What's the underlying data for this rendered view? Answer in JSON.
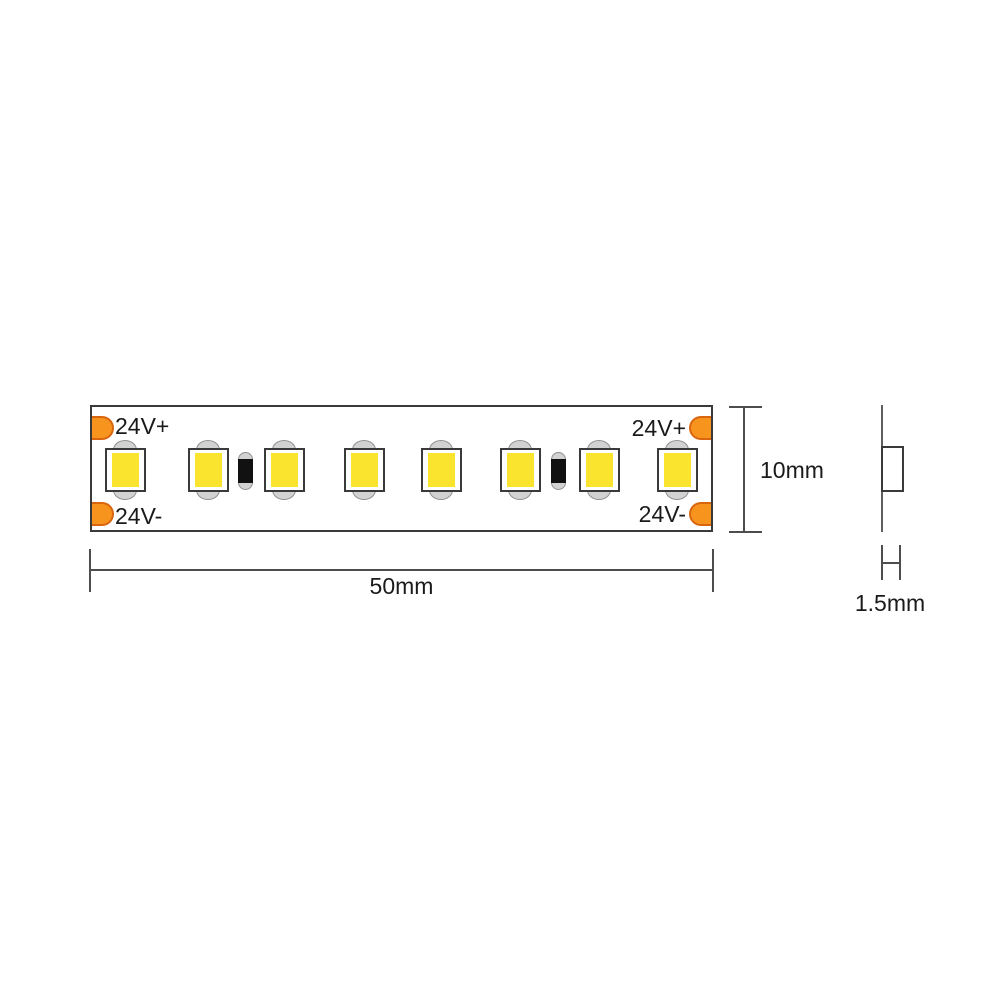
{
  "diagram": {
    "type": "led-strip-dimension-drawing",
    "pads": {
      "positive": "24V+",
      "negative": "24V-"
    },
    "dimensions": {
      "length": "50mm",
      "width": "10mm",
      "thickness": "1.5mm"
    },
    "components": {
      "led_count": 8,
      "resistor_count": 2,
      "led_centers_x": [
        125,
        208,
        284,
        364,
        441,
        520,
        599,
        677
      ],
      "resistor_centers_x": [
        245,
        558
      ]
    },
    "colors": {
      "pad_orange": "#f7941e",
      "pad_orange_border": "#d9650f",
      "led_yellow": "#fbe42d",
      "solder_tab_gray": "#d2d2d2",
      "solder_tab_border": "#909090",
      "outline_dark": "#3a3a3a",
      "dimension_line": "#4d4d4d",
      "resistor_band_black": "#111111",
      "background": "#ffffff"
    }
  }
}
